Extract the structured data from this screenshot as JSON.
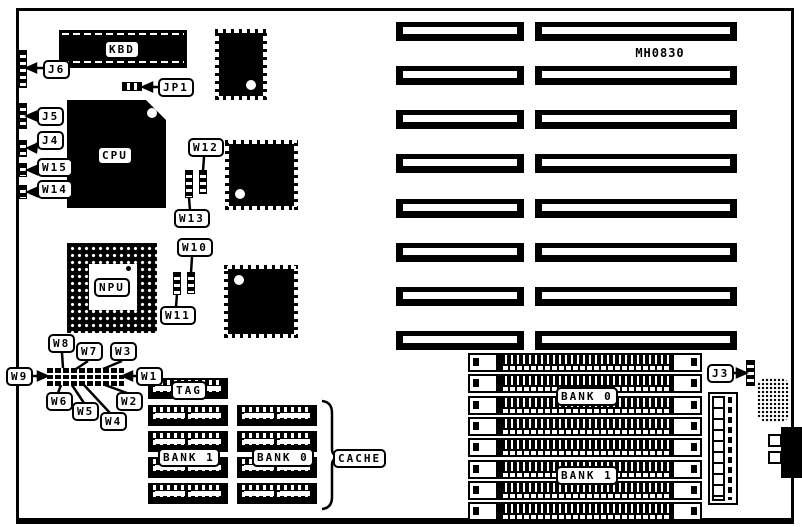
{
  "board_model": "MH0830",
  "labels": {
    "kbd": "KBD",
    "cpu": "CPU",
    "npu": "NPU",
    "tag": "TAG",
    "cache": "CACHE",
    "j6": "J6",
    "jp1": "JP1",
    "j5": "J5",
    "j4": "J4",
    "j3": "J3",
    "w1": "W1",
    "w2": "W2",
    "w3": "W3",
    "w4": "W4",
    "w5": "W5",
    "w6": "W6",
    "w7": "W7",
    "w8": "W8",
    "w9": "W9",
    "w10": "W10",
    "w11": "W11",
    "w12": "W12",
    "w13": "W13",
    "w14": "W14",
    "w15": "W15",
    "cache_bank_1": "BANK 1",
    "cache_bank_0": "BANK 0",
    "simm_bank_0": "BANK 0",
    "simm_bank_1": "BANK 1"
  },
  "structure": {
    "isa_slot_count": 8,
    "simm_socket_count": 8,
    "cache_banks": 2,
    "cache_chip_rows": 4,
    "w_block_jumper_count": 9
  }
}
